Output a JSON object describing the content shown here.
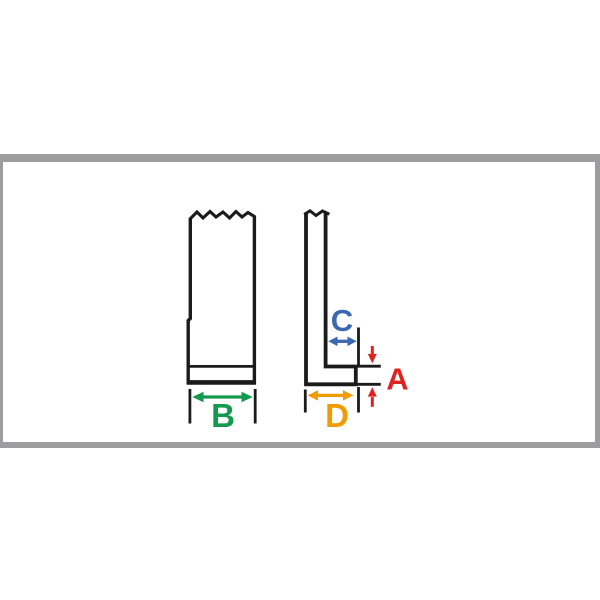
{
  "panel": {
    "background": "#ffffff",
    "border_color": "#9d9da0"
  },
  "diagram": {
    "stroke_color": "#1b1b1b",
    "labels": {
      "A": {
        "text": "A",
        "color": "#dd2420"
      },
      "B": {
        "text": "B",
        "color": "#14994f"
      },
      "C": {
        "text": "C",
        "color": "#3b68b1"
      },
      "D": {
        "text": "D",
        "color": "#f09c00"
      }
    }
  }
}
